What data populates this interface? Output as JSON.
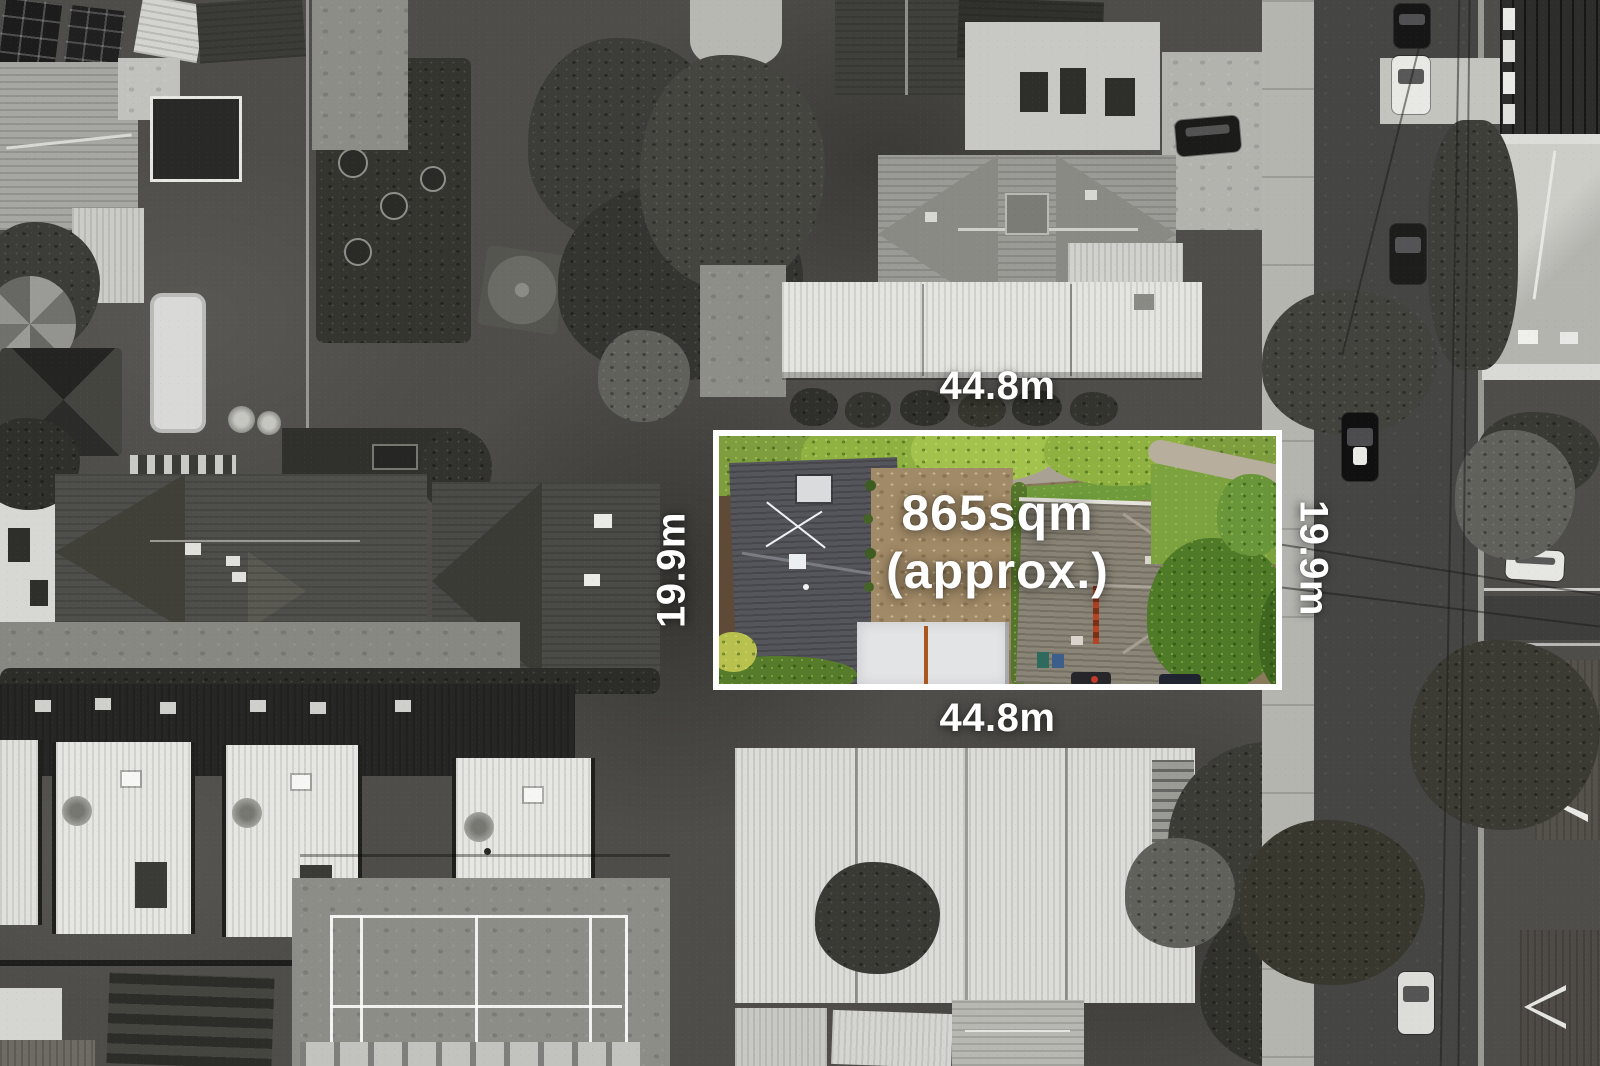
{
  "property_overlay": {
    "area_label": {
      "line1": "865sqm",
      "line2": "(approx.)"
    },
    "dimensions": {
      "top": "44.8m",
      "bottom": "44.8m",
      "left": "19.9m",
      "right": "19.9m"
    },
    "boundary_color": "#ffffff",
    "label_color": "#ffffff",
    "highlight_palette": {
      "foliage_green": "#79a03c",
      "lawn_green": "#7ba23f",
      "left_roof_gray": "#55565c",
      "right_roof_taupe": "#8b8577",
      "driveway_tan": "#a18a67",
      "slab_concrete": "#e3e4e6"
    }
  }
}
